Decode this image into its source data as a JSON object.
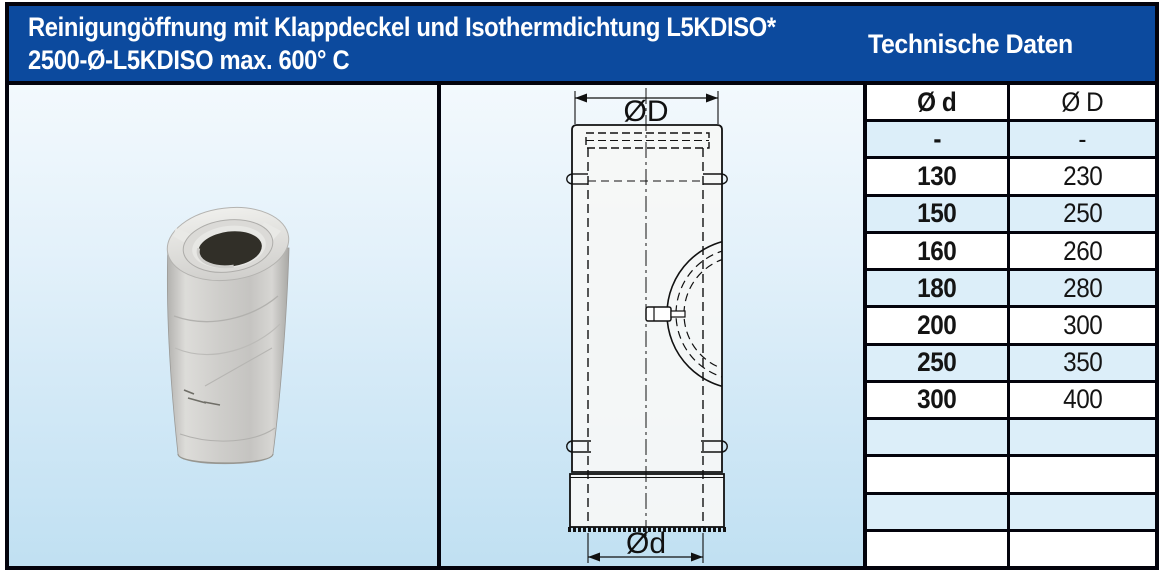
{
  "header": {
    "title_line1": "Reinigungöffnung mit Klappdeckel und Isothermdichtung L5KDISO*",
    "title_line2": "2500-Ø-L5KDISO max. 600° C",
    "section_title": "Technische Daten"
  },
  "drawing": {
    "dim_top": "ØD",
    "dim_bottom": "Ød"
  },
  "table": {
    "columns": [
      "Ø d",
      "Ø D"
    ],
    "rows": [
      [
        "-",
        "-"
      ],
      [
        "130",
        "230"
      ],
      [
        "150",
        "250"
      ],
      [
        "160",
        "260"
      ],
      [
        "180",
        "280"
      ],
      [
        "200",
        "300"
      ],
      [
        "250",
        "350"
      ],
      [
        "300",
        "400"
      ],
      [
        "",
        ""
      ],
      [
        "",
        ""
      ],
      [
        "",
        ""
      ],
      [
        "",
        ""
      ]
    ]
  },
  "colors": {
    "header_bg": "#0c4a9e",
    "frame_border": "#03030c",
    "row_alt": "#dceef9",
    "row_white": "#ffffff",
    "bg_gradient_top": "#f3f9fd",
    "bg_gradient_bottom": "#c0e0f2",
    "text": "#141414"
  }
}
